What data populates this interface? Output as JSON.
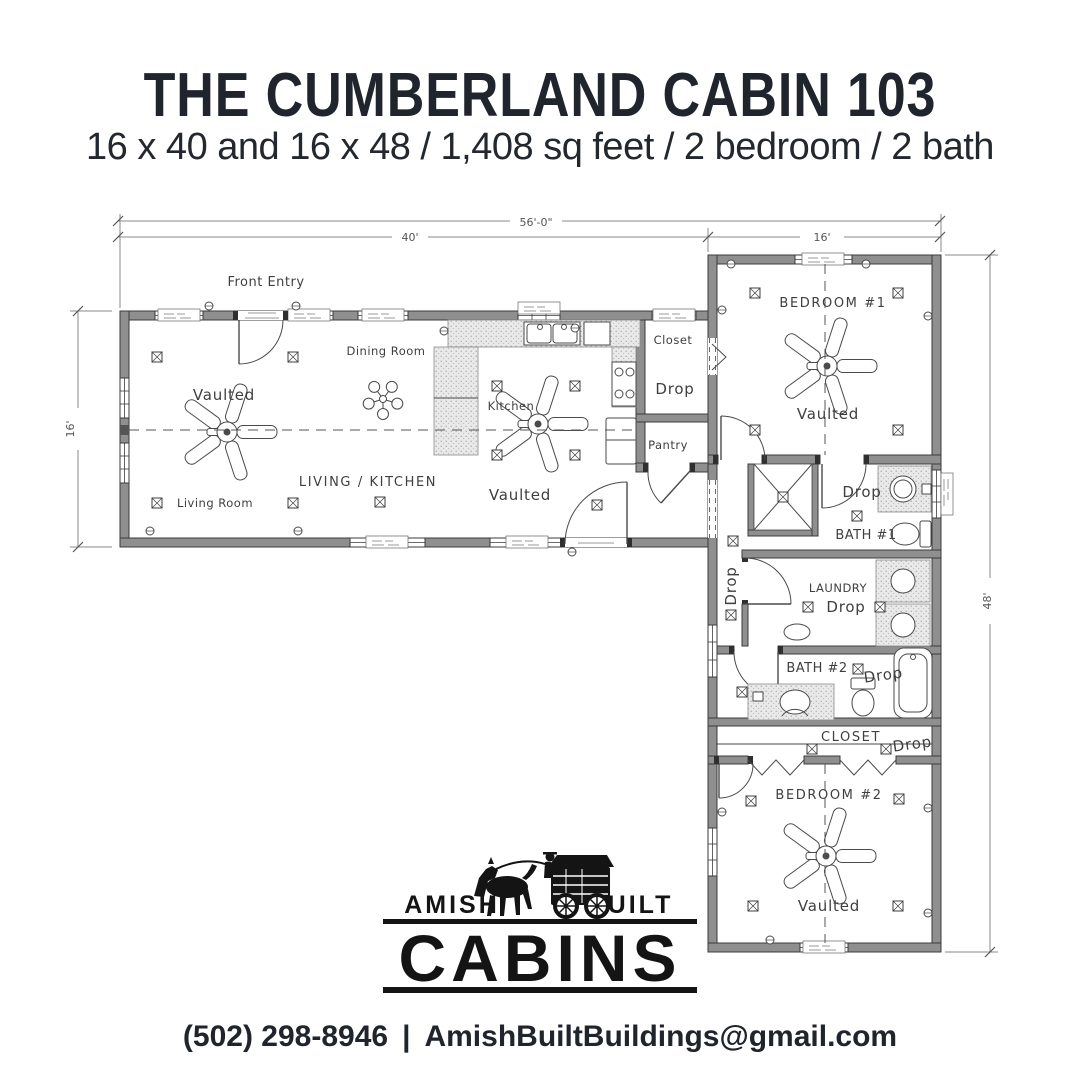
{
  "header": {
    "title": "THE CUMBERLAND CABIN 103",
    "subtitle": "16 x 40 and 16 x 48 / 1,408 sq feet / 2 bedroom / 2 bath"
  },
  "plan": {
    "dimensions": {
      "overall_width": "56'-0\"",
      "main_width": "40'",
      "wing_width": "16'",
      "main_depth": "16'",
      "wing_depth": "48'"
    },
    "rooms": {
      "front_entry": "Front Entry",
      "dining_room": "Dining Room",
      "kitchen": "Kitchen",
      "living_kitchen": "LIVING / KITCHEN",
      "living_room": "Living Room",
      "vaulted": "Vaulted",
      "closet": "Closet",
      "drop": "Drop",
      "pantry": "Pantry",
      "bedroom_1": "BEDROOM #1",
      "bath_1": "BATH #1",
      "laundry": "LAUNDRY",
      "bath_2": "BATH #2",
      "closet_2": "CLOSET",
      "bedroom_2": "BEDROOM #2"
    }
  },
  "logo": {
    "amish": "AMISH",
    "built": "BUILT",
    "cabins": "CABINS"
  },
  "footer": {
    "phone": "(502) 298-8946",
    "separator": "|",
    "email": "AmishBuiltBuildings@gmail.com"
  },
  "colors": {
    "ink": "#20242c",
    "plan_line": "#3b3b3b",
    "wall_fill": "#8f8f8f"
  }
}
